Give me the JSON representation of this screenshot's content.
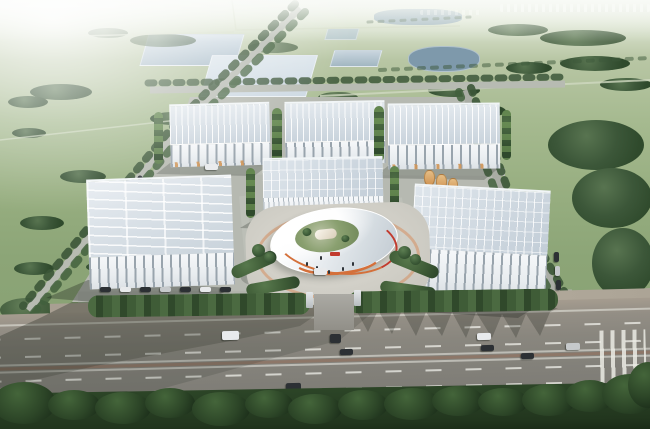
{
  "scene": {
    "description": "Aerial oblique architectural rendering of an industrial park: six white solar-roofed warehouse buildings arranged around a central white elliptical pavilion with orange and red accent rims, set on a gray concrete campus bordered by hedgerows, with green farmland, rectangular reservoirs and ponds stretching to a hazy horizon behind, tree-lined boundary roads on both sides, and a wide multi-lane highway with vehicles and a dark roadside tree row in the foreground.",
    "palette": {
      "haze": "#f3f5ef",
      "field_far": "#b8c6a4",
      "field_near": "#849d6f",
      "water_light": "#ccd8e2",
      "water_mid": "#a9bcc8",
      "lake": "#7e99ab",
      "platform": "#b6b9b1",
      "road": "#b7bbb2",
      "roof": "#c9d3dc",
      "wall": "#f1f3f5",
      "facade_stripe": "#99a4ad",
      "tree": "#3c5739",
      "tree_dark": "#2f4a2c",
      "treeline": "#22361e",
      "hedge": "#3f5c37",
      "accent_orange": "#d4703a",
      "accent_red": "#c23b2e",
      "silo": "#cf9354",
      "highway": "#84827b",
      "highway_edge": "#a59c8f",
      "median": "#8f7464",
      "vehicle_dark": "#2c3034",
      "vehicle_light": "#e8eaec",
      "shadow": "rgba(30,36,28,0.33)"
    },
    "counts": {
      "warehouses": 6,
      "central_pavilions": 1,
      "ponds": 6,
      "highway_vehicles": 9,
      "parked_vehicles": 16,
      "storage_silos": 3,
      "people_on_plaza": 6,
      "dashed_lane_rows": 4
    }
  }
}
